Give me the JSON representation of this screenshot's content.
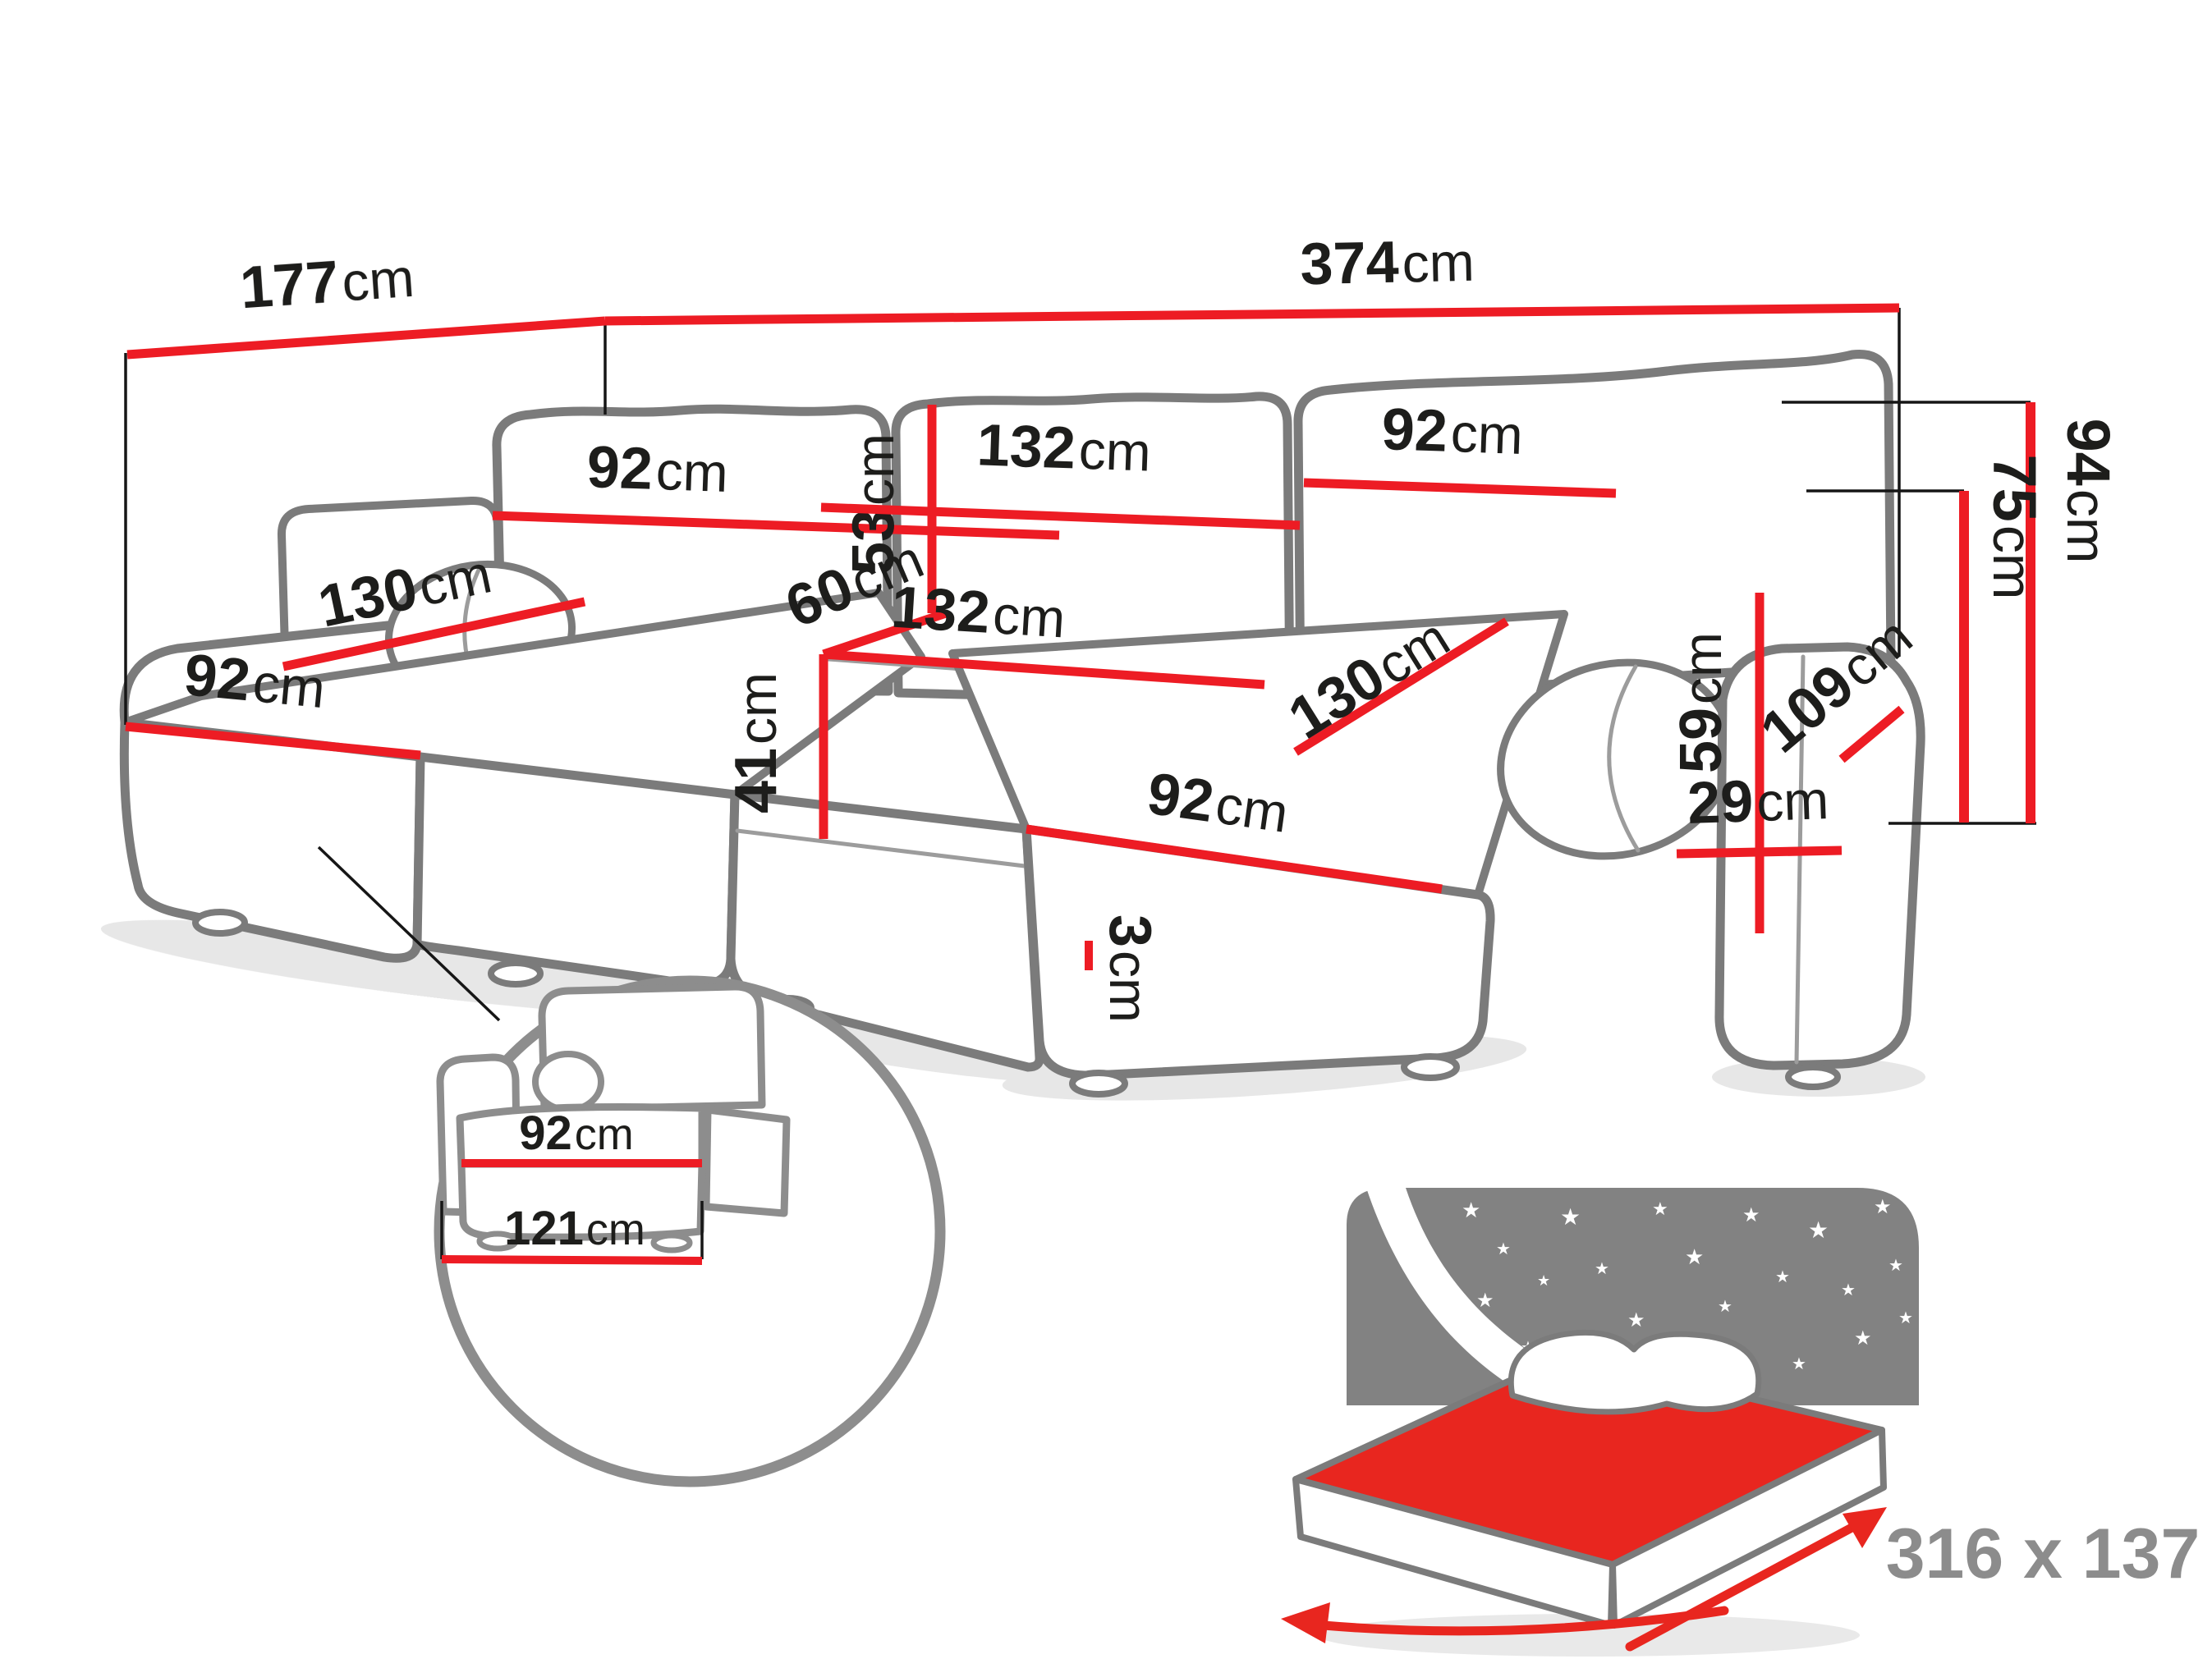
{
  "title": "U-shaped corner sofa dimensions diagram",
  "colors": {
    "dimension_red": "#ed1c24",
    "extension_black": "#161616",
    "sofa_outline_gray": "#7b7b7b",
    "inset_circle_gray": "#8d8d8d",
    "bed_headboard_gray": "#828282",
    "bed_size_text_gray": "#8c8c8c",
    "background": "#ffffff"
  },
  "dims": {
    "d177": {
      "value": "177",
      "unit": "cm"
    },
    "d374": {
      "value": "374",
      "unit": "cm"
    },
    "d92_back_left": {
      "value": "92",
      "unit": "cm"
    },
    "d53": {
      "value": "53",
      "unit": "cm"
    },
    "d132_back": {
      "value": "132",
      "unit": "cm"
    },
    "d92_back_right": {
      "value": "92",
      "unit": "cm"
    },
    "d60": {
      "value": "60",
      "unit": "cm"
    },
    "d132_seat": {
      "value": "132",
      "unit": "cm"
    },
    "d41": {
      "value": "41",
      "unit": "cm"
    },
    "d130_left": {
      "value": "130",
      "unit": "cm"
    },
    "d92_front_left": {
      "value": "92",
      "unit": "cm"
    },
    "d130_right": {
      "value": "130",
      "unit": "cm"
    },
    "d92_front_right": {
      "value": "92",
      "unit": "cm"
    },
    "d3": {
      "value": "3",
      "unit": "cm"
    },
    "d59": {
      "value": "59",
      "unit": "cm"
    },
    "d29": {
      "value": "29",
      "unit": "cm"
    },
    "d109": {
      "value": "109",
      "unit": "cm"
    },
    "d94": {
      "value": "94",
      "unit": "cm"
    },
    "d75": {
      "value": "75",
      "unit": "cm"
    }
  },
  "inset": {
    "d92": {
      "value": "92",
      "unit": "cm"
    },
    "d121": {
      "value": "121",
      "unit": "cm"
    }
  },
  "bed": {
    "size_label": "316 x 137",
    "star": "★"
  }
}
